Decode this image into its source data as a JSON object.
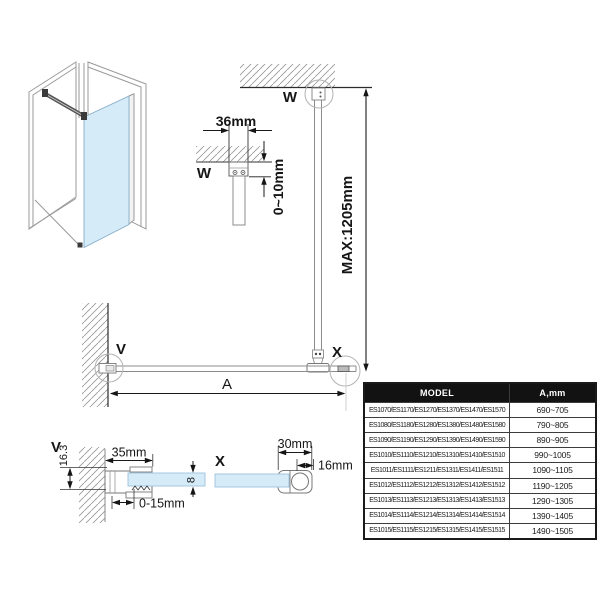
{
  "labels": {
    "w": "W",
    "v": "V",
    "x": "X",
    "dim_bracket_width": "36mm",
    "dim_ceiling_gap": "0~10mm",
    "dim_max_height": "MAX:1205mm",
    "dim_span": "A",
    "dim_wall_offset": "16.3",
    "dim_wall_bracket": "35mm",
    "dim_adjust_range": "0-15mm",
    "dim_glass_thickness": "8",
    "dim_clamp_width": "30mm",
    "dim_bar_diameter": "16mm"
  },
  "colors": {
    "glass": "#d6ebf8",
    "glass_edge": "#86aec9",
    "line_gray": "#8c8c8c",
    "dimension": "#1a1a1a",
    "table_header_bg": "#121212",
    "table_header_text": "#ffffff"
  },
  "table": {
    "headers": [
      "MODEL",
      "A,mm"
    ],
    "rows": [
      {
        "model": "ES1070/ES1170/ES1270/ES1370/ES1470/ES1570",
        "a_mm": "690~705"
      },
      {
        "model": "ES1080/ES1180/ES1280/ES1380/ES1480/ES1580",
        "a_mm": "790~805"
      },
      {
        "model": "ES1090/ES1190/ES1290/ES1390/ES1490/ES1590",
        "a_mm": "890~905"
      },
      {
        "model": "ES1010/ES1110/ES1210/ES1310/ES1410/ES1510",
        "a_mm": "990~1005"
      },
      {
        "model": "ES1011/ES1111/ES1211/ES1311/ES1411/ES1511",
        "a_mm": "1090~1105"
      },
      {
        "model": "ES1012/ES1112/ES1212/ES1312/ES1412/ES1512",
        "a_mm": "1190~1205"
      },
      {
        "model": "ES1013/ES1113/ES1213/ES1313/ES1413/ES1513",
        "a_mm": "1290~1305"
      },
      {
        "model": "ES1014/ES1114/ES1214/ES1314/ES1414/ES1514",
        "a_mm": "1390~1405"
      },
      {
        "model": "ES1015/ES1115/ES1215/ES1315/ES1415/ES1515",
        "a_mm": "1490~1505"
      }
    ]
  }
}
